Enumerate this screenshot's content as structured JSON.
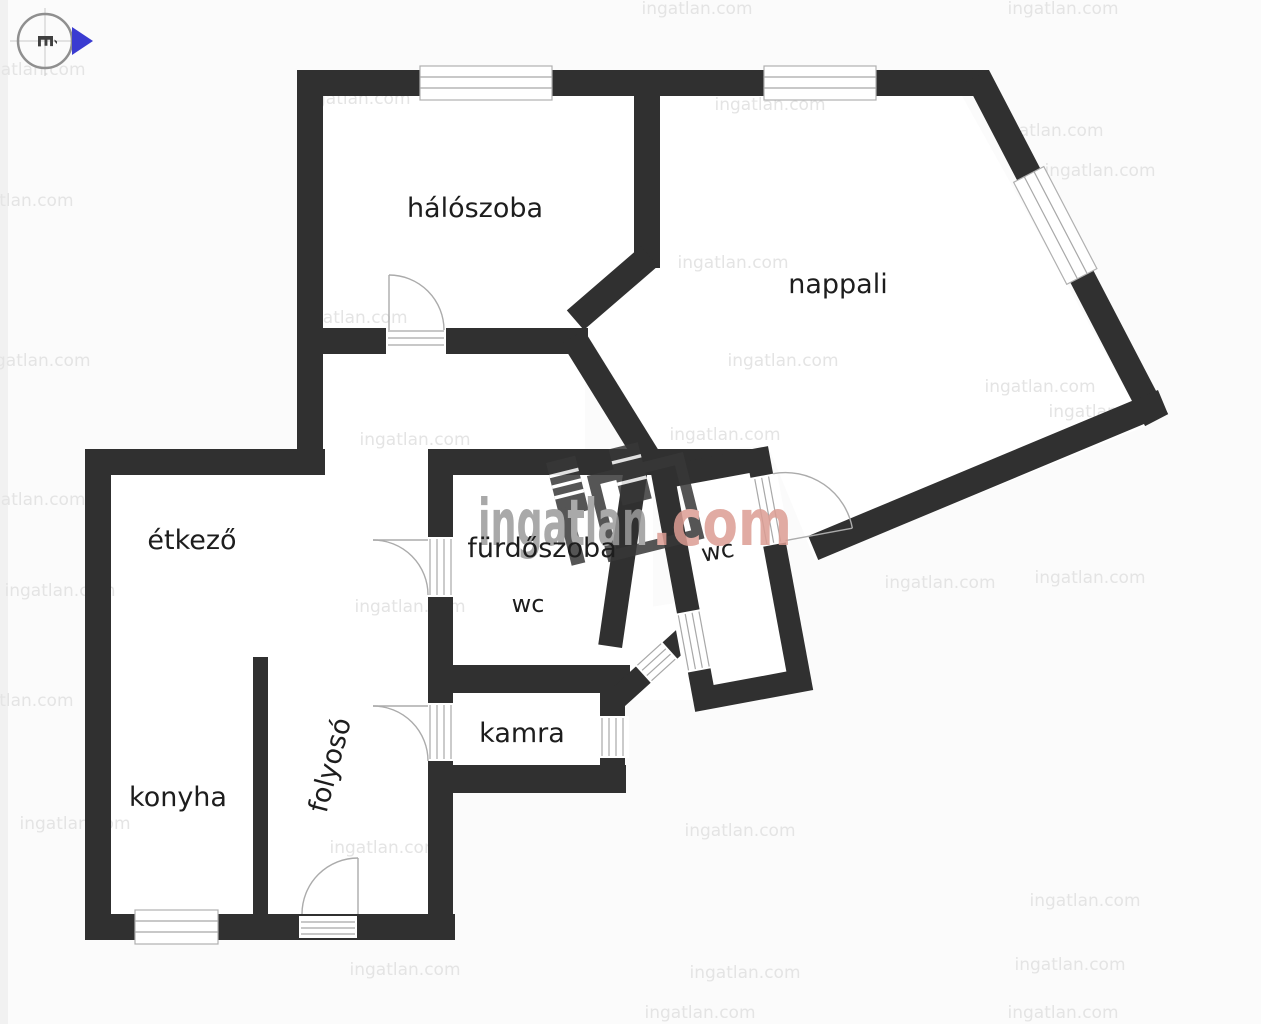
{
  "page": {
    "background": "#fbfbfb"
  },
  "compass": {
    "letter": "É"
  },
  "watermark": {
    "brand": "ingatlan",
    "tld": ".com",
    "tile": "ingatlan.com"
  },
  "colors": {
    "wall": "#303030",
    "fixture_gray": "#ababab",
    "label": "#1d1d1d",
    "brand_gray": "#9b9b9b",
    "brand_accent": "#dc9d93",
    "tile_gray": "#e4e4e4",
    "compass_arrow": "#3a3bd1"
  },
  "rooms": {
    "haloszoba": {
      "label": "hálószoba"
    },
    "nappali": {
      "label": "nappali"
    },
    "etkezo": {
      "label": "étkező"
    },
    "furdoszoba": {
      "label": "fürdőszoba"
    },
    "wc_furdoszoba": {
      "label": "wc"
    },
    "wc_kulon": {
      "label": "wc"
    },
    "kamra": {
      "label": "kamra"
    },
    "folyoso": {
      "label": "folyosó"
    },
    "konyha": {
      "label": "konyha"
    }
  }
}
